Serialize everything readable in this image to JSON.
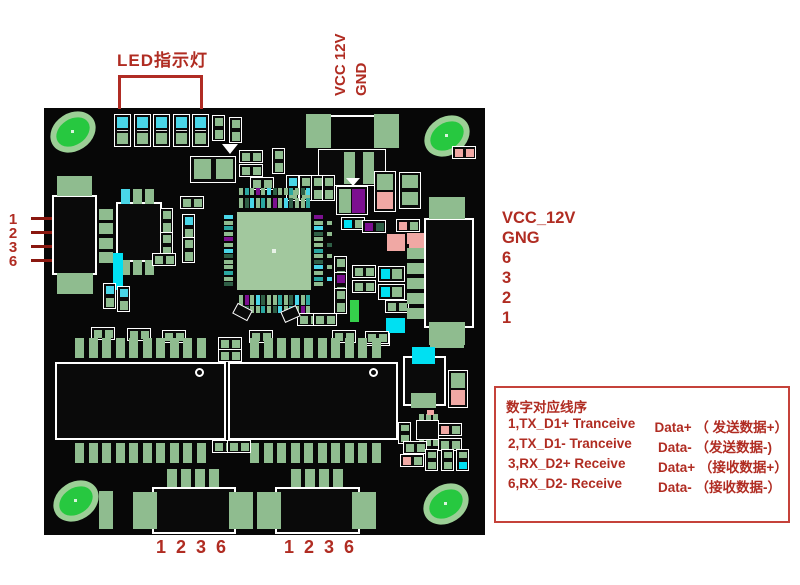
{
  "colors": {
    "annotation_red": "#b02c22",
    "arrow_line_red": "#8a1810",
    "legend_border_red": "#c5423a",
    "board_black": "#070707",
    "pad_green": "#8fbc8f",
    "bright_green": "#27c840",
    "hole_ring_green": "#9ccf96",
    "cyan": "#49d6e8",
    "bright_cyan": "#00e0f2",
    "purple": "#7c1090",
    "pink": "#f0a8a4",
    "chip_body_green": "#a2c89e",
    "silkscreen_white": "#ffffff"
  },
  "annotations": {
    "led_label": "LED指示灯",
    "top_power": {
      "line1": "VCC 12V",
      "line2": "GND"
    },
    "left_pins": [
      "1",
      "2",
      "3",
      "6"
    ],
    "right_panel": {
      "line1": "VCC_12V",
      "line2": "GNG",
      "pins": [
        "6",
        "3",
        "2",
        "1"
      ]
    },
    "bottom_pins_left": [
      "1",
      "2",
      "3",
      "6"
    ],
    "bottom_pins_right": [
      "1",
      "2",
      "3",
      "6"
    ],
    "legend": {
      "title": "数字对应线序",
      "rows": [
        {
          "signal": "1,TX_D1+ Tranceive",
          "data": "Data+ （ 发送数据+）"
        },
        {
          "signal": "2,TX_D1- Tranceive",
          "data": "Data- （发送数据-)"
        },
        {
          "signal": "3,RX_D2+ Receive",
          "data": "Data+ （接收数据+）"
        },
        {
          "signal": "6,RX_D2- Receive",
          "data": "Data- （接收数据-）"
        }
      ]
    }
  }
}
